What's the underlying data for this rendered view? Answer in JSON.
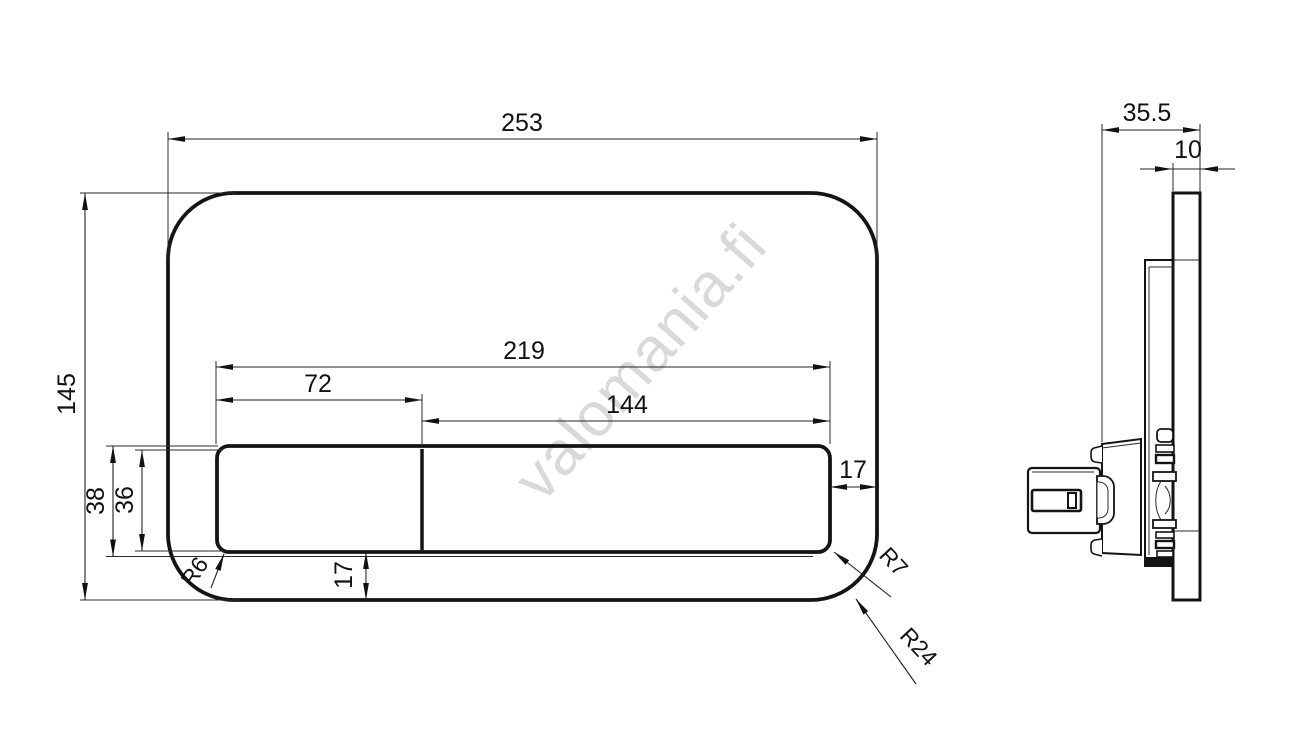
{
  "watermark": {
    "text": "valomania.fi"
  },
  "front_view": {
    "dim_overall_width": "253",
    "dim_overall_height": "145",
    "dim_button_area_width": "219",
    "dim_left_button_width": "72",
    "dim_right_button_width": "144",
    "dim_button_band_outer_height": "38",
    "dim_button_band_inner_height": "36",
    "dim_button_bottom_gap": "17",
    "dim_button_right_gap": "17",
    "label_radius_button_left": "R6",
    "label_radius_button_right": "R7",
    "label_radius_plate_corner": "R24"
  },
  "side_view": {
    "dim_total_depth": "35.5",
    "dim_plate_thickness": "10"
  }
}
